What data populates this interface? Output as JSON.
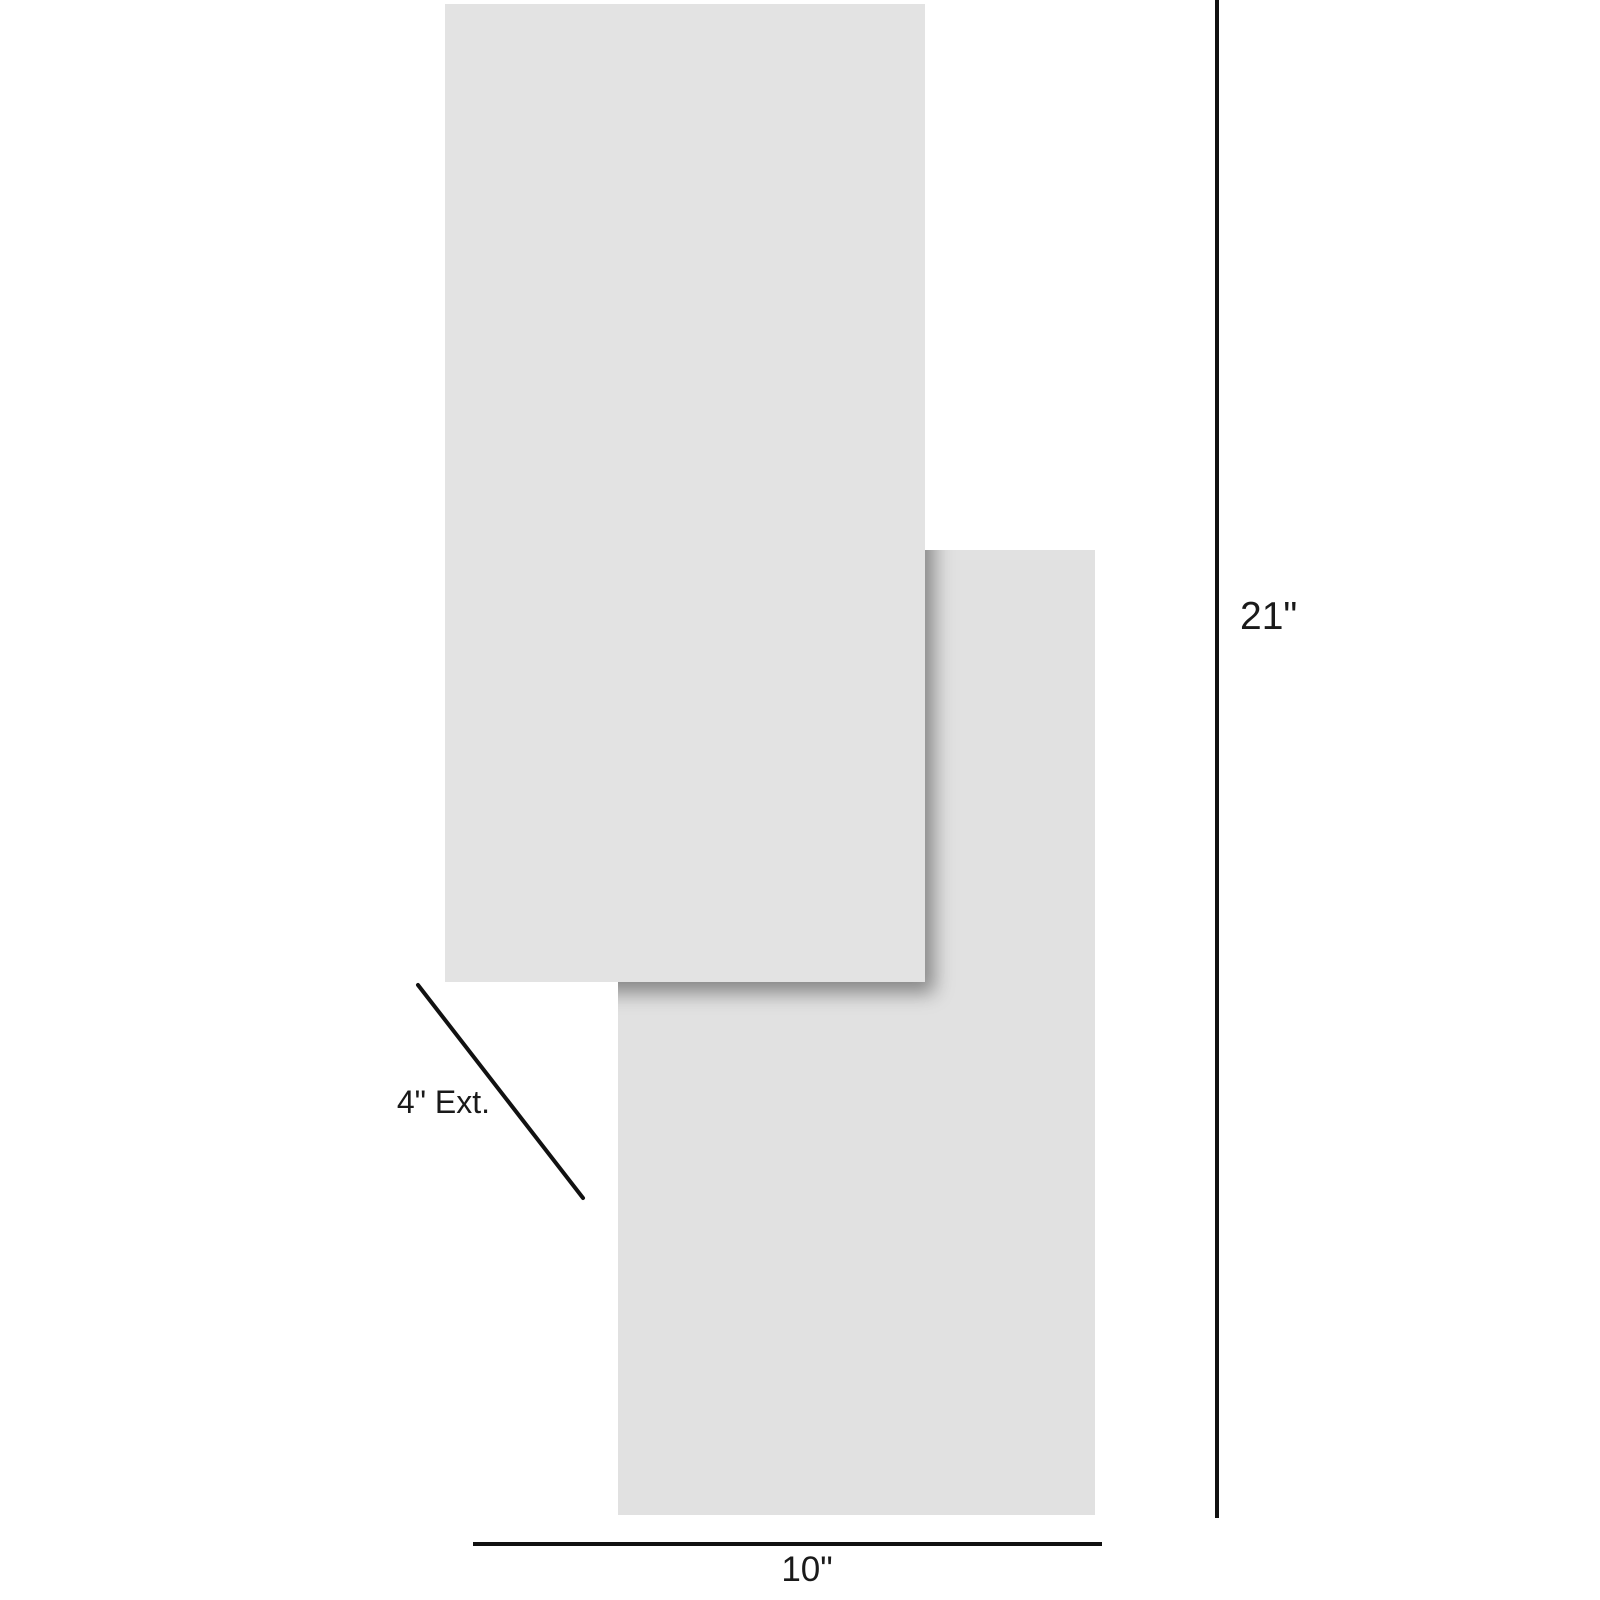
{
  "diagram": {
    "type": "product-dimension-diagram",
    "subject": "two offset overlapping rectangular panels (front panel overlaps upper-left, back panel lower-right)"
  },
  "colors": {
    "background": "#ffffff",
    "panel_front": "#e3e3e3",
    "panel_back": "#e1e1e1",
    "line": "#111111",
    "text": "#1a1a1a"
  },
  "dimensions": {
    "height": {
      "label": "21\"",
      "value": 21,
      "unit": "inches"
    },
    "width": {
      "label": "10\"",
      "value": 10,
      "unit": "inches"
    },
    "extension": {
      "label": "4\" Ext.",
      "value": 4,
      "unit": "inches"
    }
  }
}
